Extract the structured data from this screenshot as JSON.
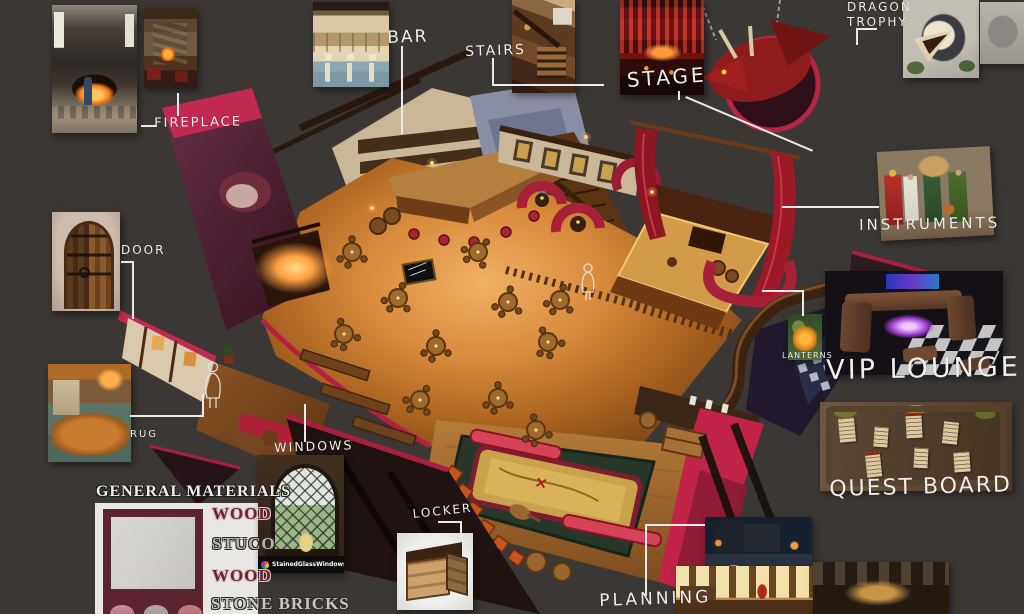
{
  "background_color": "#3a3734",
  "accent_pink": "#c22447",
  "label_color": "#f0eeec",
  "labels": {
    "fireplace": "FIREPLACE",
    "bar": "BAR",
    "stairs": "STAIRS",
    "stage": "STAGE",
    "dragon_trophy": "DRAGON TROPHY",
    "instruments": "INSTRUMENTS",
    "lanterns": "LANTERNS",
    "vip_lounge": "VIP LOUNGE",
    "quest_board": "QUEST BOARD",
    "door": "DOOR",
    "rug": "RUG",
    "windows": "WINDOWS",
    "locker": "LOCKER",
    "planning": "PLANNING"
  },
  "materials": {
    "title": "GENERAL MATERIALS",
    "items": [
      {
        "label": "WOOD",
        "color": "#6e2030"
      },
      {
        "label": "STUCO",
        "color": "#b6b2ac"
      },
      {
        "label": "WOOD",
        "color": "#6e2030"
      },
      {
        "label": "STONE BRICKS",
        "color": "#c9c5bf"
      }
    ]
  },
  "watermark": {
    "text": "StainedGlassWindows.com",
    "logo_icon": "rainbow-circle"
  }
}
